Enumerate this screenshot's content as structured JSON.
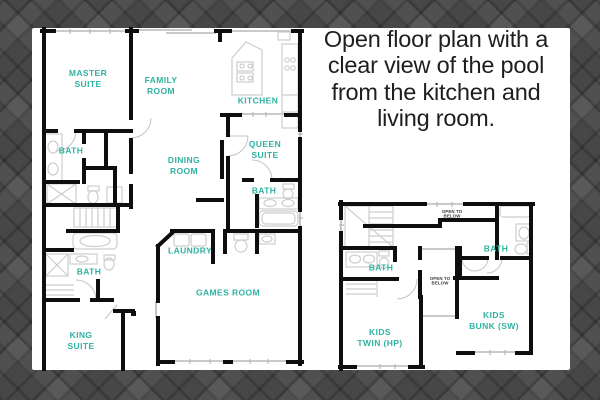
{
  "caption": {
    "text": "Open floor plan with a\nclear view of the pool\nfrom the kitchen and\nliving room."
  },
  "colors": {
    "label_teal": "#2fb2a2",
    "wall_black": "#0e0e0e",
    "fixture_gray": "#cdcdcd",
    "window_gray": "#b8b8b8",
    "panel_white": "#ffffff",
    "background_gray": "#474747",
    "caption_black": "#1e1e1e"
  },
  "floor1": {
    "labels": [
      {
        "id": "master-suite",
        "text": "MASTER\nSUITE"
      },
      {
        "id": "family-room",
        "text": "FAMILY\nROOM"
      },
      {
        "id": "kitchen",
        "text": "KITCHEN"
      },
      {
        "id": "bath-master",
        "text": "BATH"
      },
      {
        "id": "dining-room",
        "text": "DINING\nROOM"
      },
      {
        "id": "queen-suite",
        "text": "QUEEN\nSUITE"
      },
      {
        "id": "bath-queen",
        "text": "BATH"
      },
      {
        "id": "laundry",
        "text": "LAUNDRY"
      },
      {
        "id": "bath-hall",
        "text": "BATH"
      },
      {
        "id": "games-room",
        "text": "GAMES ROOM"
      },
      {
        "id": "king-suite",
        "text": "KING\nSUITE"
      }
    ]
  },
  "floor2": {
    "labels": [
      {
        "id": "open-to-below-top",
        "text": "OPEN TO\nBELOW"
      },
      {
        "id": "bath-upper-right",
        "text": "BATH"
      },
      {
        "id": "bath-upper-left",
        "text": "BATH"
      },
      {
        "id": "open-to-below-mid",
        "text": "OPEN TO\nBELOW"
      },
      {
        "id": "kids-twin",
        "text": "KIDS\nTWIN (HP)"
      },
      {
        "id": "kids-bunk",
        "text": "KIDS\nBUNK (SW)"
      }
    ]
  }
}
